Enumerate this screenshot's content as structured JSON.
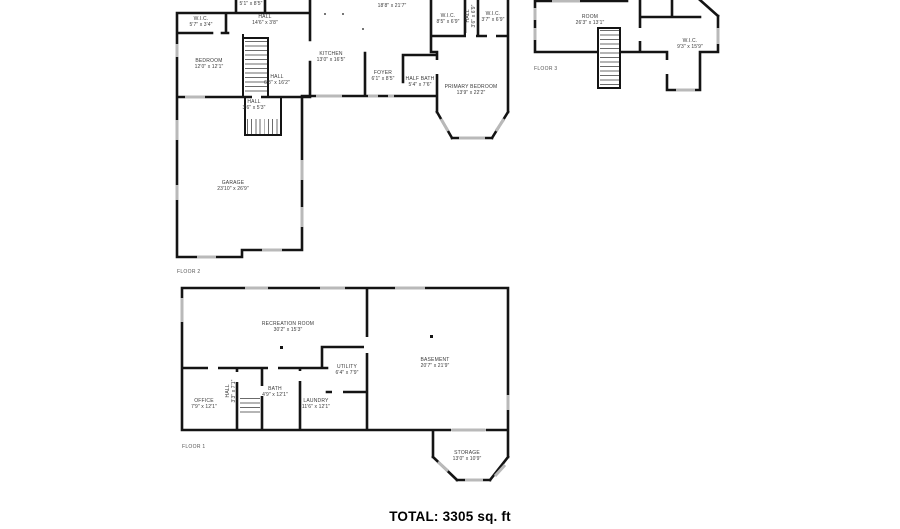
{
  "summary": {
    "total_label": "TOTAL: 3305 sq. ft"
  },
  "colors": {
    "wall": "#141414",
    "window": "#b9b9b9",
    "label_text": "#3a3a3a",
    "total_text": "#000000"
  },
  "floor2": {
    "floor_label": "FLOOR 2",
    "rooms": {
      "wic_top_left": {
        "name": "W.I.C.",
        "dims": "5'7\" x 3'4\""
      },
      "hall_top": {
        "name": "HALL",
        "dims": "14'6\" x 3'8\""
      },
      "upper_partial": {
        "name": "",
        "dims": "5'1\" x 8'5\""
      },
      "living_partial": {
        "name": "",
        "dims": "18'8\" x 21'7\""
      },
      "bedroom": {
        "name": "BEDROOM",
        "dims": "12'0\" x 12'1\""
      },
      "kitchen": {
        "name": "KITCHEN",
        "dims": "13'0\" x 16'5\""
      },
      "hall_mid": {
        "name": "HALL",
        "dims": "6'8\" x 16'2\""
      },
      "hall_small": {
        "name": "HALL",
        "dims": "3'6\" x 5'3\""
      },
      "foyer": {
        "name": "FOYER",
        "dims": "6'1\" x 8'5\""
      },
      "half_bath": {
        "name": "HALF BATH",
        "dims": "5'4\" x 7'6\""
      },
      "primary_bedroom": {
        "name": "PRIMARY BEDROOM",
        "dims": "13'9\" x 22'2\""
      },
      "wic_left": {
        "name": "W.I.C.",
        "dims": "8'5\" x 6'9\""
      },
      "hall_closet": {
        "name": "HALL",
        "dims": "3'6\" x 6'9\""
      },
      "wic_right": {
        "name": "W.I.C.",
        "dims": "3'7\" x 6'9\""
      },
      "garage": {
        "name": "GARAGE",
        "dims": "23'10\" x 26'9\""
      }
    }
  },
  "floor3": {
    "floor_label": "FLOOR 3",
    "rooms": {
      "room": {
        "name": "ROOM",
        "dims": "26'3\" x 13'1\""
      },
      "wic": {
        "name": "W.I.C.",
        "dims": "9'3\" x 15'9\""
      }
    }
  },
  "floor1": {
    "floor_label": "FLOOR 1",
    "rooms": {
      "recreation_room": {
        "name": "RECREATION ROOM",
        "dims": "30'2\" x 15'3\""
      },
      "office": {
        "name": "OFFICE",
        "dims": "7'9\" x 12'1\""
      },
      "hall": {
        "name": "HALL",
        "dims": "3'3\" x 7'1\""
      },
      "bath": {
        "name": "BATH",
        "dims": "4'9\" x 12'1\""
      },
      "laundry": {
        "name": "LAUNDRY",
        "dims": "11'6\" x 12'1\""
      },
      "utility": {
        "name": "UTILITY",
        "dims": "6'4\" x 7'9\""
      },
      "basement": {
        "name": "BASEMENT",
        "dims": "20'7\" x 21'9\""
      },
      "storage": {
        "name": "STORAGE",
        "dims": "13'0\" x 10'9\""
      }
    }
  }
}
